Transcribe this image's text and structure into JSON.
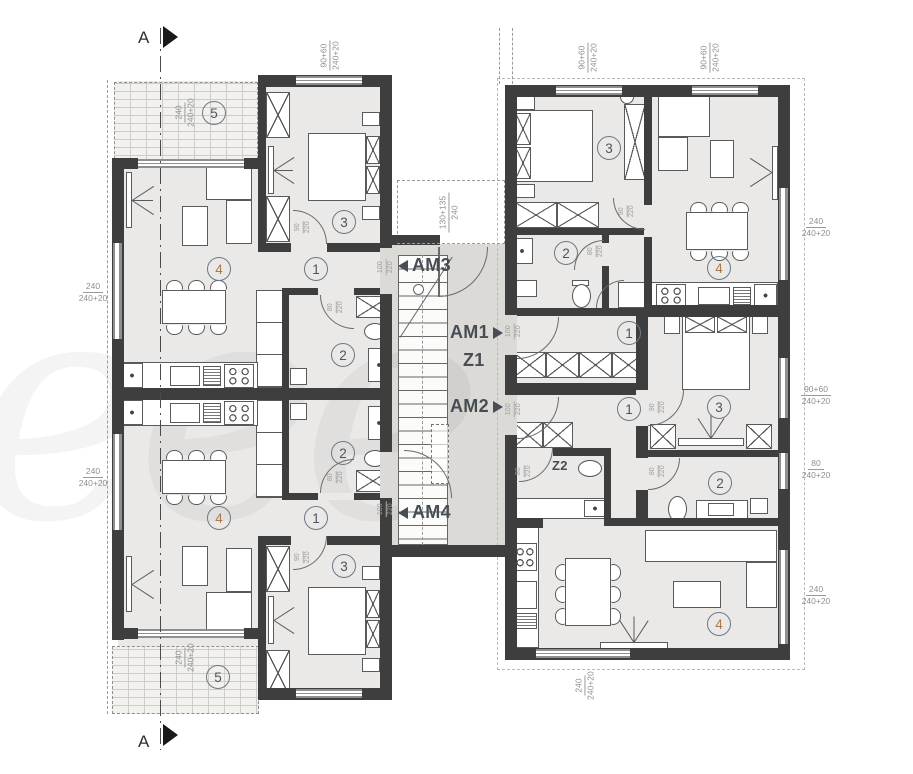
{
  "drawing": {
    "section_marker": "A",
    "stairwell": {
      "z1": "Z1",
      "am1": "AM1",
      "am2": "AM2",
      "am3": "AM3",
      "am4": "AM4"
    },
    "wc_room": {
      "z2": "Z2"
    },
    "room_numbers": {
      "hall": "1",
      "bathroom": "2",
      "bedroom": "3",
      "living": "4",
      "balcony": "5"
    },
    "door_sizes": {
      "w100": "100",
      "w90": "90",
      "w80": "80",
      "h220": "220"
    },
    "window_dims": {
      "win_90_60": {
        "width": "90+60",
        "sill": "240+20"
      },
      "win_240": {
        "width": "240",
        "sill": "240+20"
      },
      "win_80": {
        "width": "80",
        "sill": "240+20"
      },
      "stair_opening": {
        "width": "130+135",
        "sill": "240"
      }
    },
    "watermark_text": "eee",
    "colors": {
      "wall": "#3e3e3e",
      "room_fill": "#eae9e7",
      "stair_fill": "#dcdad6",
      "number": "#4b5662",
      "living_number": "#a87848"
    }
  }
}
